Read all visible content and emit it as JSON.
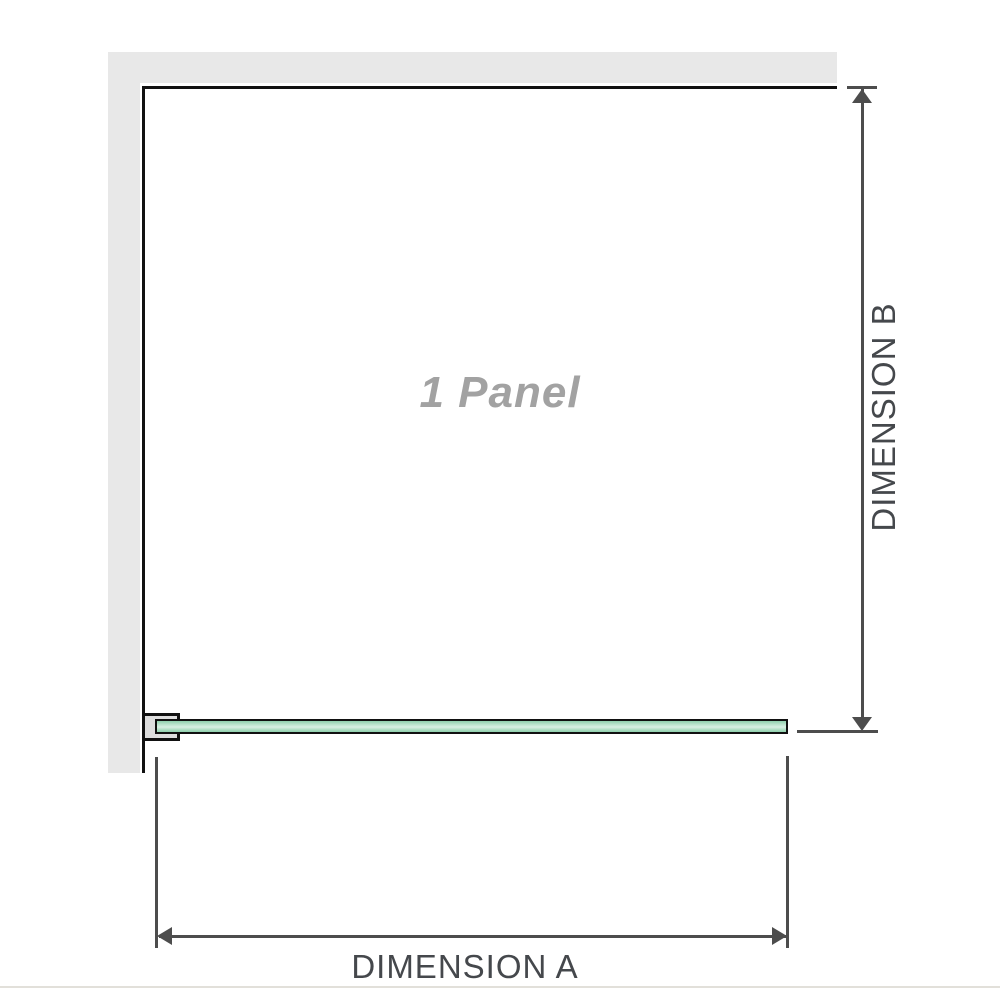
{
  "diagram": {
    "title": "shower-screen-panel-dimension-diagram",
    "panel": {
      "label": "1 Panel"
    },
    "dimensions": {
      "a_label": "DIMENSION A",
      "b_label": "DIMENSION B"
    },
    "colors": {
      "wall": "#e8e8e8",
      "outline": "#111111",
      "dimension": "#4d4d4d",
      "dimension_text": "#45484c",
      "glass_green": "#8fd0ad",
      "glass_green_light": "#d9f0e4",
      "panel_text": "#a2a2a2",
      "divider": "#e2e0da"
    }
  }
}
